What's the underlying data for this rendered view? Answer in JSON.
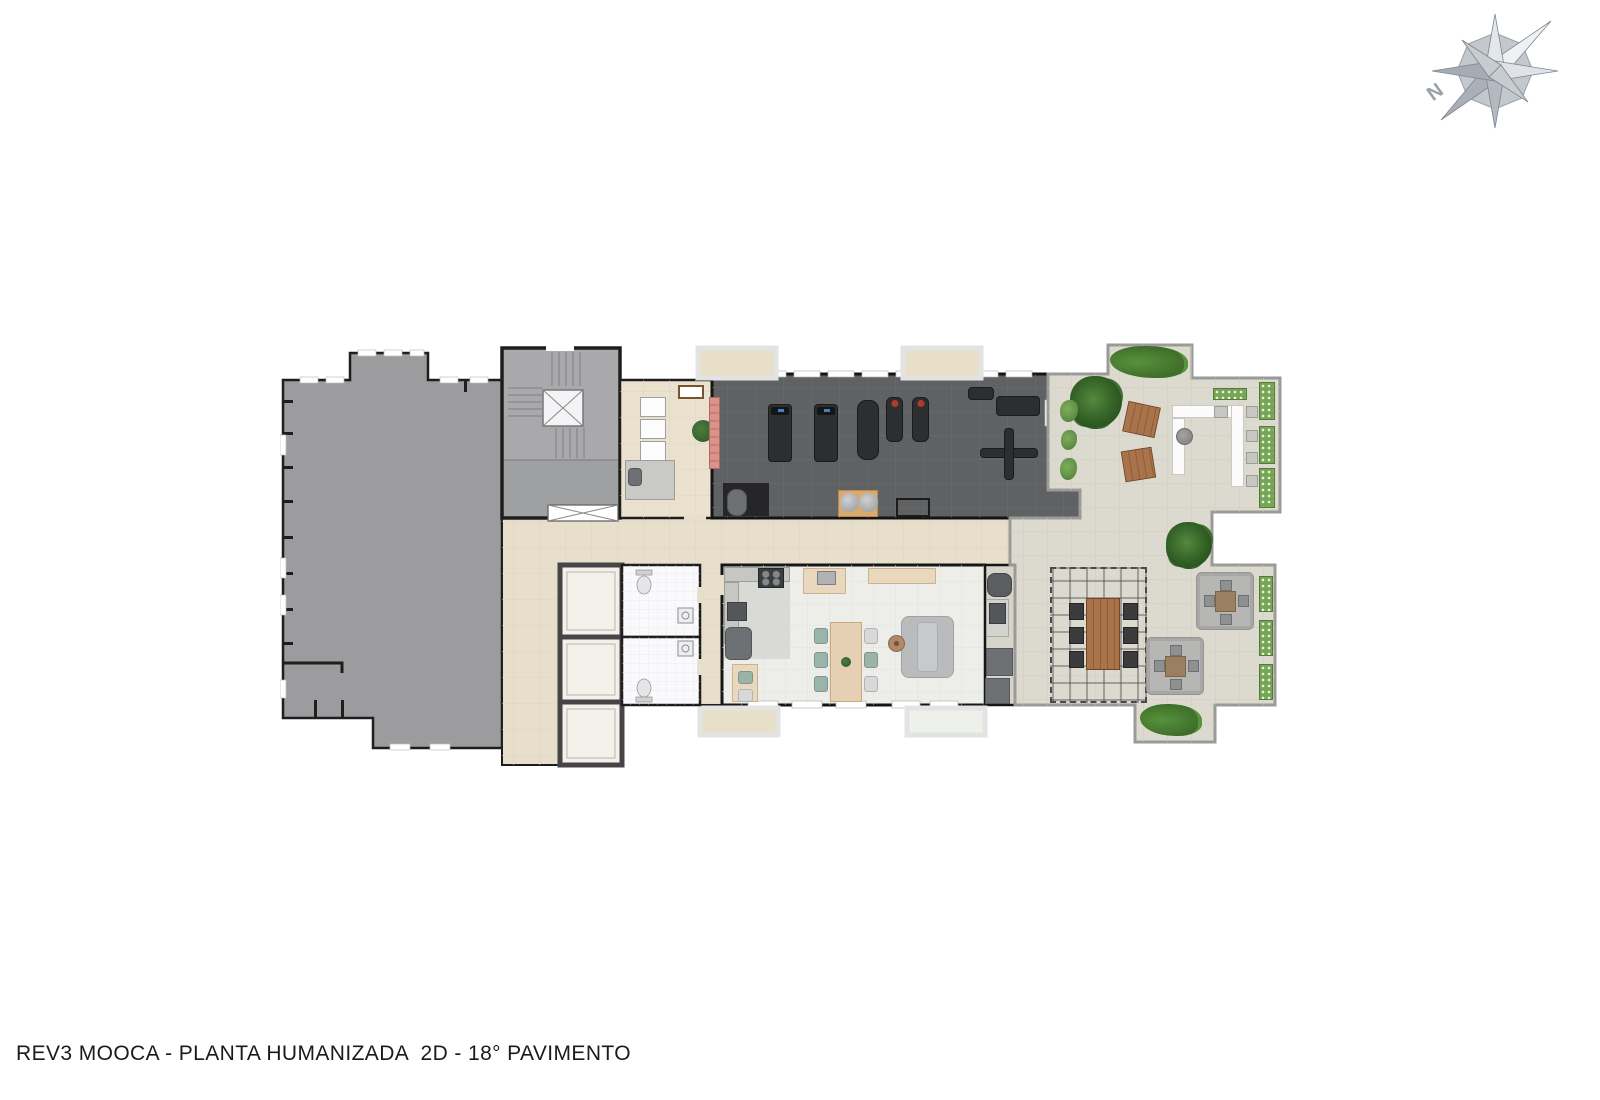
{
  "title": "REV3 MOOCA - PLANTA HUMANIZADA  2D - 18° PAVIMENTO",
  "compass": {
    "north_label": "N"
  },
  "palette": {
    "page_bg": "#ffffff",
    "ink": "#1b1b1b",
    "wall": "#1e1e1e",
    "leftwing": "#9c9c9e",
    "core": "#a9a9ab",
    "corridor": "#e7dfcc",
    "support": "#eae2cf",
    "gym_floor": "#5f6163",
    "party_floor": "#edeee9",
    "kitchen_tile": "#d9d9d6",
    "terrace": "#dcd9cf",
    "elevator": "#f4f1eb",
    "elevator_frame": "#454547",
    "bath": "#fafafc",
    "equip_dark": "#2d2e30",
    "appliance": "#6e7173",
    "wood": "#a9744a",
    "wood_dark": "#8b5a2b",
    "plant_green": "#3f7d35",
    "hedge_green": "#77a556",
    "bench_salmon": "#d9938a",
    "table_beige": "#e9d8be",
    "chair_green": "#9cb3aa",
    "chair_white": "#d8d8d8",
    "sofa_gray": "#babbbc",
    "umbrella": "#b6b6b4",
    "stone_edge": "#9a9a97"
  }
}
